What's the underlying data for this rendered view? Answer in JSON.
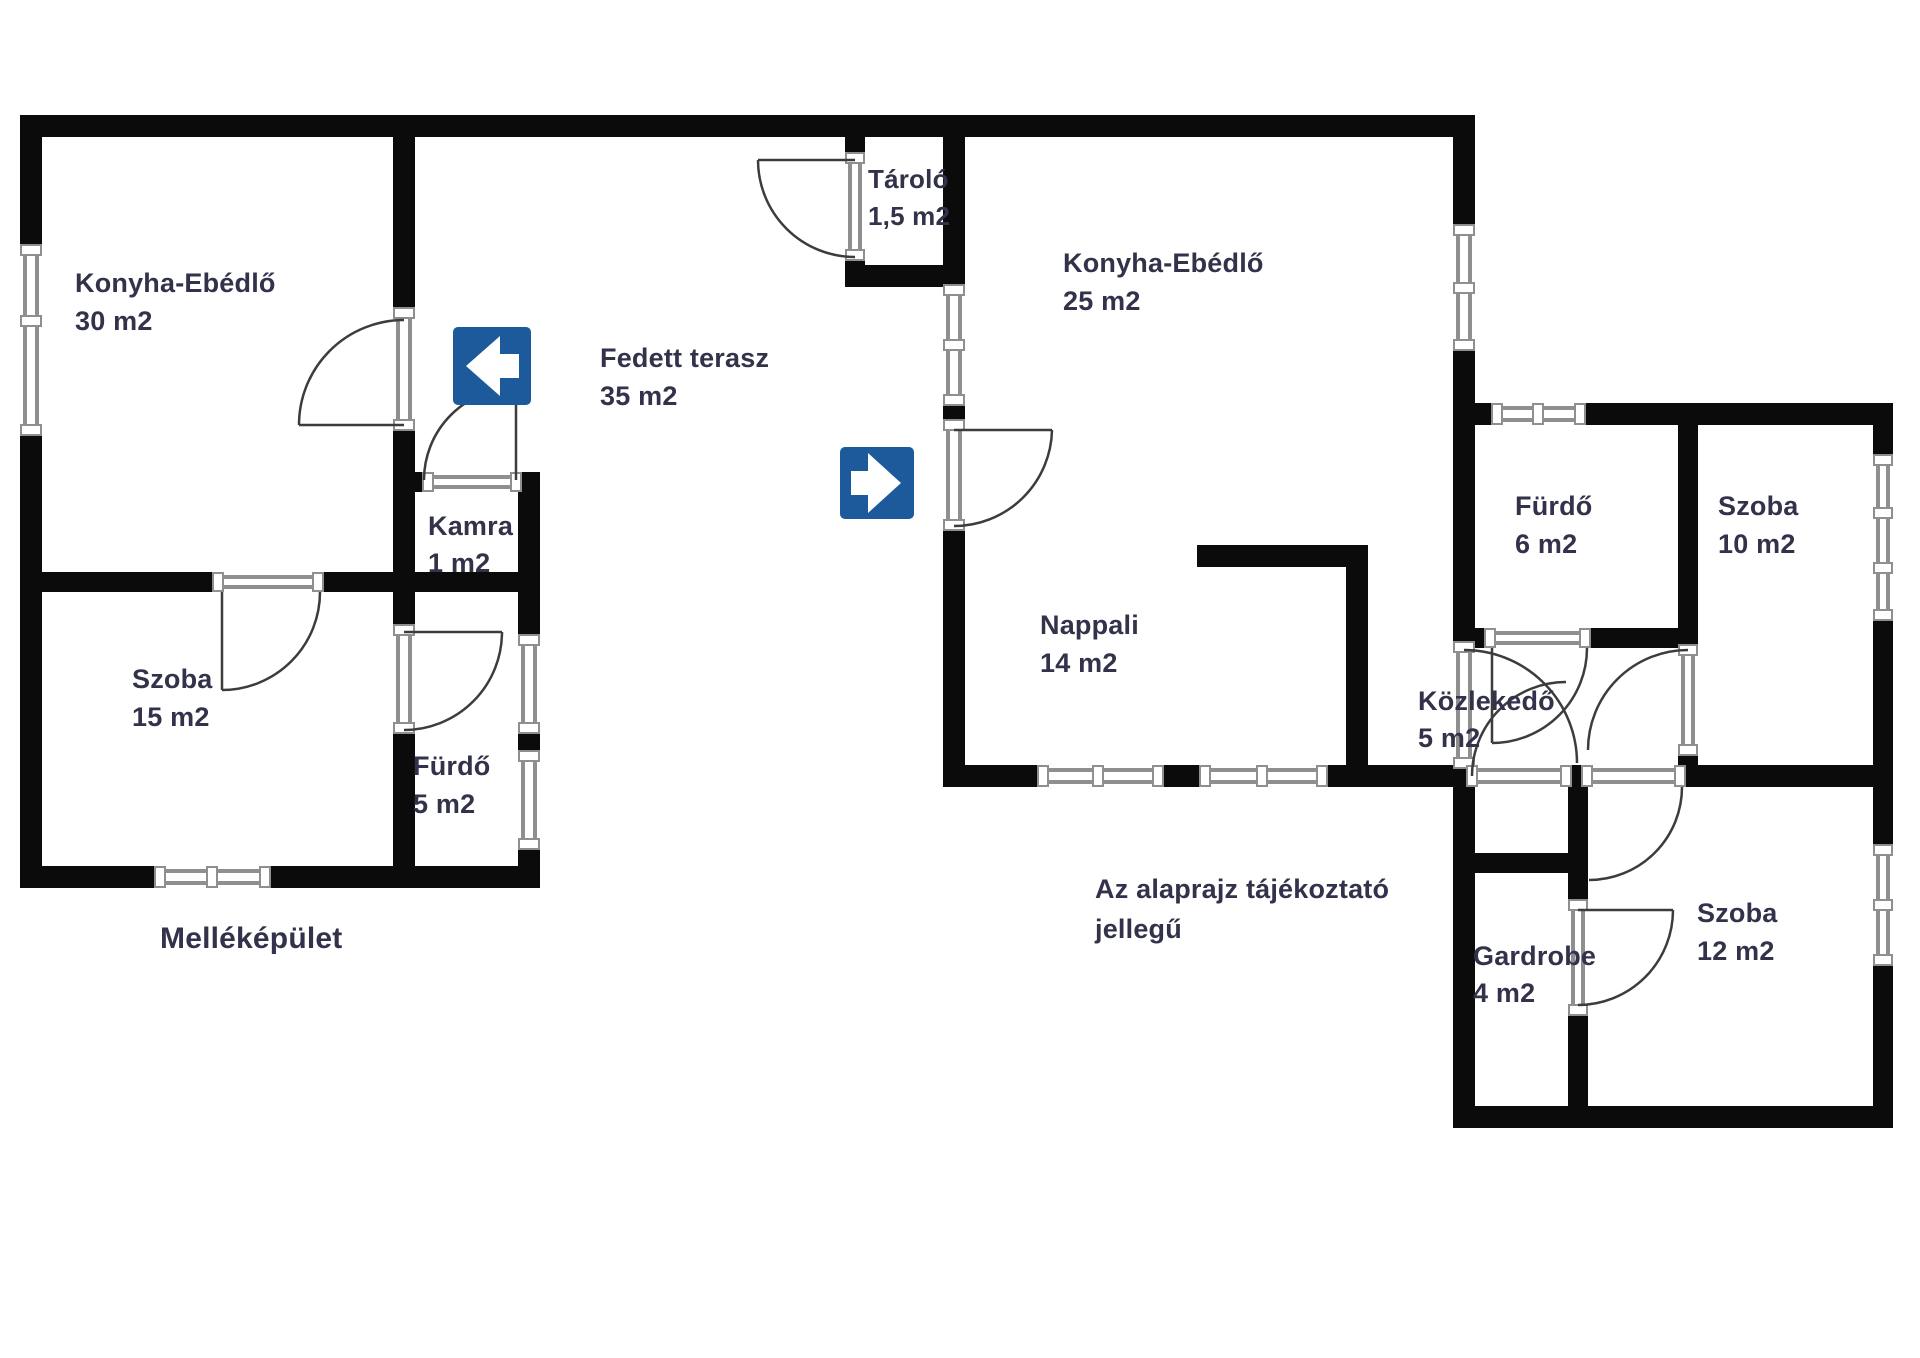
{
  "plan": {
    "title": "Melléképület",
    "note_line1": "Az alaprajz tájékoztató",
    "note_line2": "jellegű",
    "colors": {
      "wall": "#0b0b0b",
      "window": "#8f8f8f",
      "door_arc": "#3c3c3c",
      "label": "#32324b",
      "sign_blue": "#1d5a9b",
      "background": "#ffffff"
    },
    "rooms": [
      {
        "id": "konyha-ebedlo-30",
        "name": "Konyha-Ebédlő",
        "area": "30 m2"
      },
      {
        "id": "tarolo",
        "name": "Tároló",
        "area": "1,5 m2"
      },
      {
        "id": "fedett-terasz",
        "name": "Fedett terasz",
        "area": "35 m2"
      },
      {
        "id": "konyha-ebedlo-25",
        "name": "Konyha-Ebédlő",
        "area": "25 m2"
      },
      {
        "id": "kamra",
        "name": "Kamra",
        "area": "1 m2"
      },
      {
        "id": "szoba-15",
        "name": "Szoba",
        "area": "15 m2"
      },
      {
        "id": "furdo-5",
        "name": "Fürdő",
        "area": "5 m2"
      },
      {
        "id": "nappali",
        "name": "Nappali",
        "area": "14 m2"
      },
      {
        "id": "furdo-6",
        "name": "Fürdő",
        "area": "6 m2"
      },
      {
        "id": "szoba-10",
        "name": "Szoba",
        "area": "10 m2"
      },
      {
        "id": "kozlekedo",
        "name": "Közlekedő",
        "area": "5 m2"
      },
      {
        "id": "gardrobe",
        "name": "Gardrobe",
        "area": "4 m2"
      },
      {
        "id": "szoba-12",
        "name": "Szoba",
        "area": "12 m2"
      }
    ],
    "signs": [
      {
        "id": "arrow-left",
        "direction": "left"
      },
      {
        "id": "arrow-right",
        "direction": "right"
      }
    ]
  }
}
